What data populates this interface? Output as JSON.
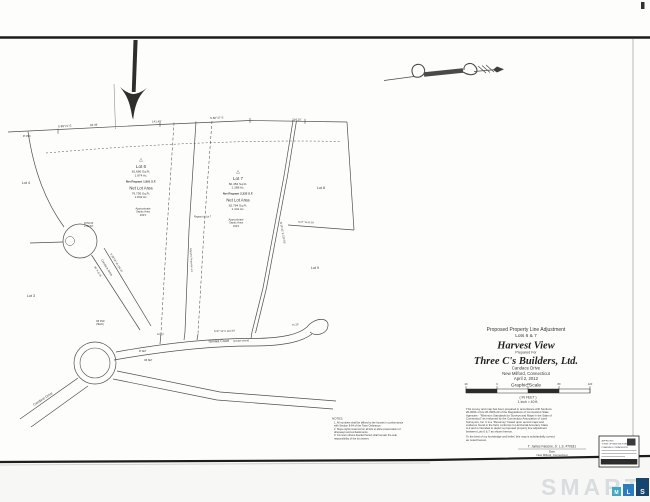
{
  "map": {
    "adjacent": {
      "lot4": "Lot 4",
      "lot3": "Lot 3",
      "lot8": "Lot 8",
      "lot9": "Lot 9"
    },
    "lot6": {
      "tri": "△",
      "name": "Lot 6",
      "gross_sf": "81,686 Sq.Ft.",
      "gross_ac": "1.874 Ac.",
      "regrant": "Net Regrant 1,891 S.F.",
      "net_label": "Net Lot Area",
      "net_sf": "79,795 Sq.Ft.",
      "net_ac": "1.832 Ac.",
      "septic1": "Approximate",
      "septic2": "Septic Area",
      "septic3": "100'±"
    },
    "lot7": {
      "tri": "△",
      "name": "Lot 7",
      "gross_sf": "60,452 Sq.Ft.",
      "gross_ac": "1.388 Ac.",
      "regrant": "Net Regrant 2,332 S.F.",
      "net_label": "Net Lot Area",
      "net_sf": "62,784 Sq.Ft.",
      "net_ac": "1.441 Ac.",
      "septic1": "Approximate",
      "septic2": "Septic Area",
      "septic3": "100'±"
    },
    "roads": {
      "tamika": "Tamika Court",
      "tamika_note": "(private street)",
      "candace": "Candace Drive",
      "candace_upper": "Candace Drive",
      "row": "50' R.O.W."
    },
    "bearings": {
      "b1": "S 89°21' E",
      "b1d": "94.49'",
      "b2": "141.49'",
      "b3": "S 88°47' E",
      "b4": "234.10'",
      "b5": "S 38°06' W  134.21'",
      "b6": "N 16°42' E  212.55'",
      "b7": "62.13'",
      "b8": "S 87°12' E  110.00'",
      "b9": "75.25'",
      "b10": "N 87° W  65.00'"
    },
    "points": {
      "p1": "CB FND",
      "p1b": "(HELD)",
      "p2": "IP SET",
      "p3": "CB SET",
      "p4": "IP FND",
      "curve1": "R=50.00'",
      "curve2": "L=62.83'"
    },
    "annot": {
      "adj": "Adjusted Property Line",
      "regrant": "Regrant to Lot 7"
    }
  },
  "title_block": {
    "line1": "Proposed Property Line Adjustment",
    "line2": "Lots 6 & 7",
    "project": "Harvest View",
    "prepared_for": "Prepared For",
    "client": "Three C's Builders, Ltd.",
    "street": "Candace Drive",
    "town": "New Milford, Connecticut",
    "date": "April 2, 2012"
  },
  "scale": {
    "label": "Graphic Scale",
    "numbers": [
      "40",
      "0",
      "40",
      "80",
      "120"
    ],
    "unit": "( IN FEET )",
    "ratio": "1 inch = 40 ft."
  },
  "notes": {
    "heading": "NOTES:",
    "lines": [
      "1.  All numbers shall be affixed to the houses in conformance",
      "      with Section 8-64 of the Town Ordinance.",
      "2.  Slope rights reserved on all lots to allow preservation of",
      "      driveways and embankments.",
      "3.  Common drives deeded herein shall remain the sole",
      "      responsibility of the lot owners."
    ]
  },
  "certification": {
    "lines": [
      "This survey and map has been prepared in accordance with Sections",
      "20-300b-1 thru 20-300b-20 of the Regulations of Connecticut State",
      "Agencies - \"Minimum Standards for Surveys and Maps in the State of",
      "Connecticut\" as endorsed by the Connecticut Association of Land",
      "Surveyors, Inc.  It is a \"Resurvey\" based upon record maps and",
      "evidence found in the field, conforms to Horizontal Accuracy Class",
      "A-2 and is intended to depict a proposed property line adjustment",
      "between Lots 6 & 7 as shown hereon."
    ],
    "closing1": "To the best of my knowledge and belief, this map is substantially correct",
    "closing2": "as noted hereon.",
    "signature": "T. James Falcone, Jr.   L.S. #70181",
    "date_label": "Date",
    "place": "New Milford, Connecticut"
  },
  "stamp": {
    "l1": "APPROVED",
    "l2": "TOWN OF NEW MILFORD",
    "l3": "PLANNING COMMISSION",
    "footer": "LAND RECORDS"
  },
  "watermark": {
    "word": "SMART",
    "blocks": [
      {
        "letter": "M",
        "color": "#3fa9c0"
      },
      {
        "letter": "L",
        "color": "#2e7cc0"
      },
      {
        "letter": "S",
        "color": "#16456e"
      }
    ]
  }
}
